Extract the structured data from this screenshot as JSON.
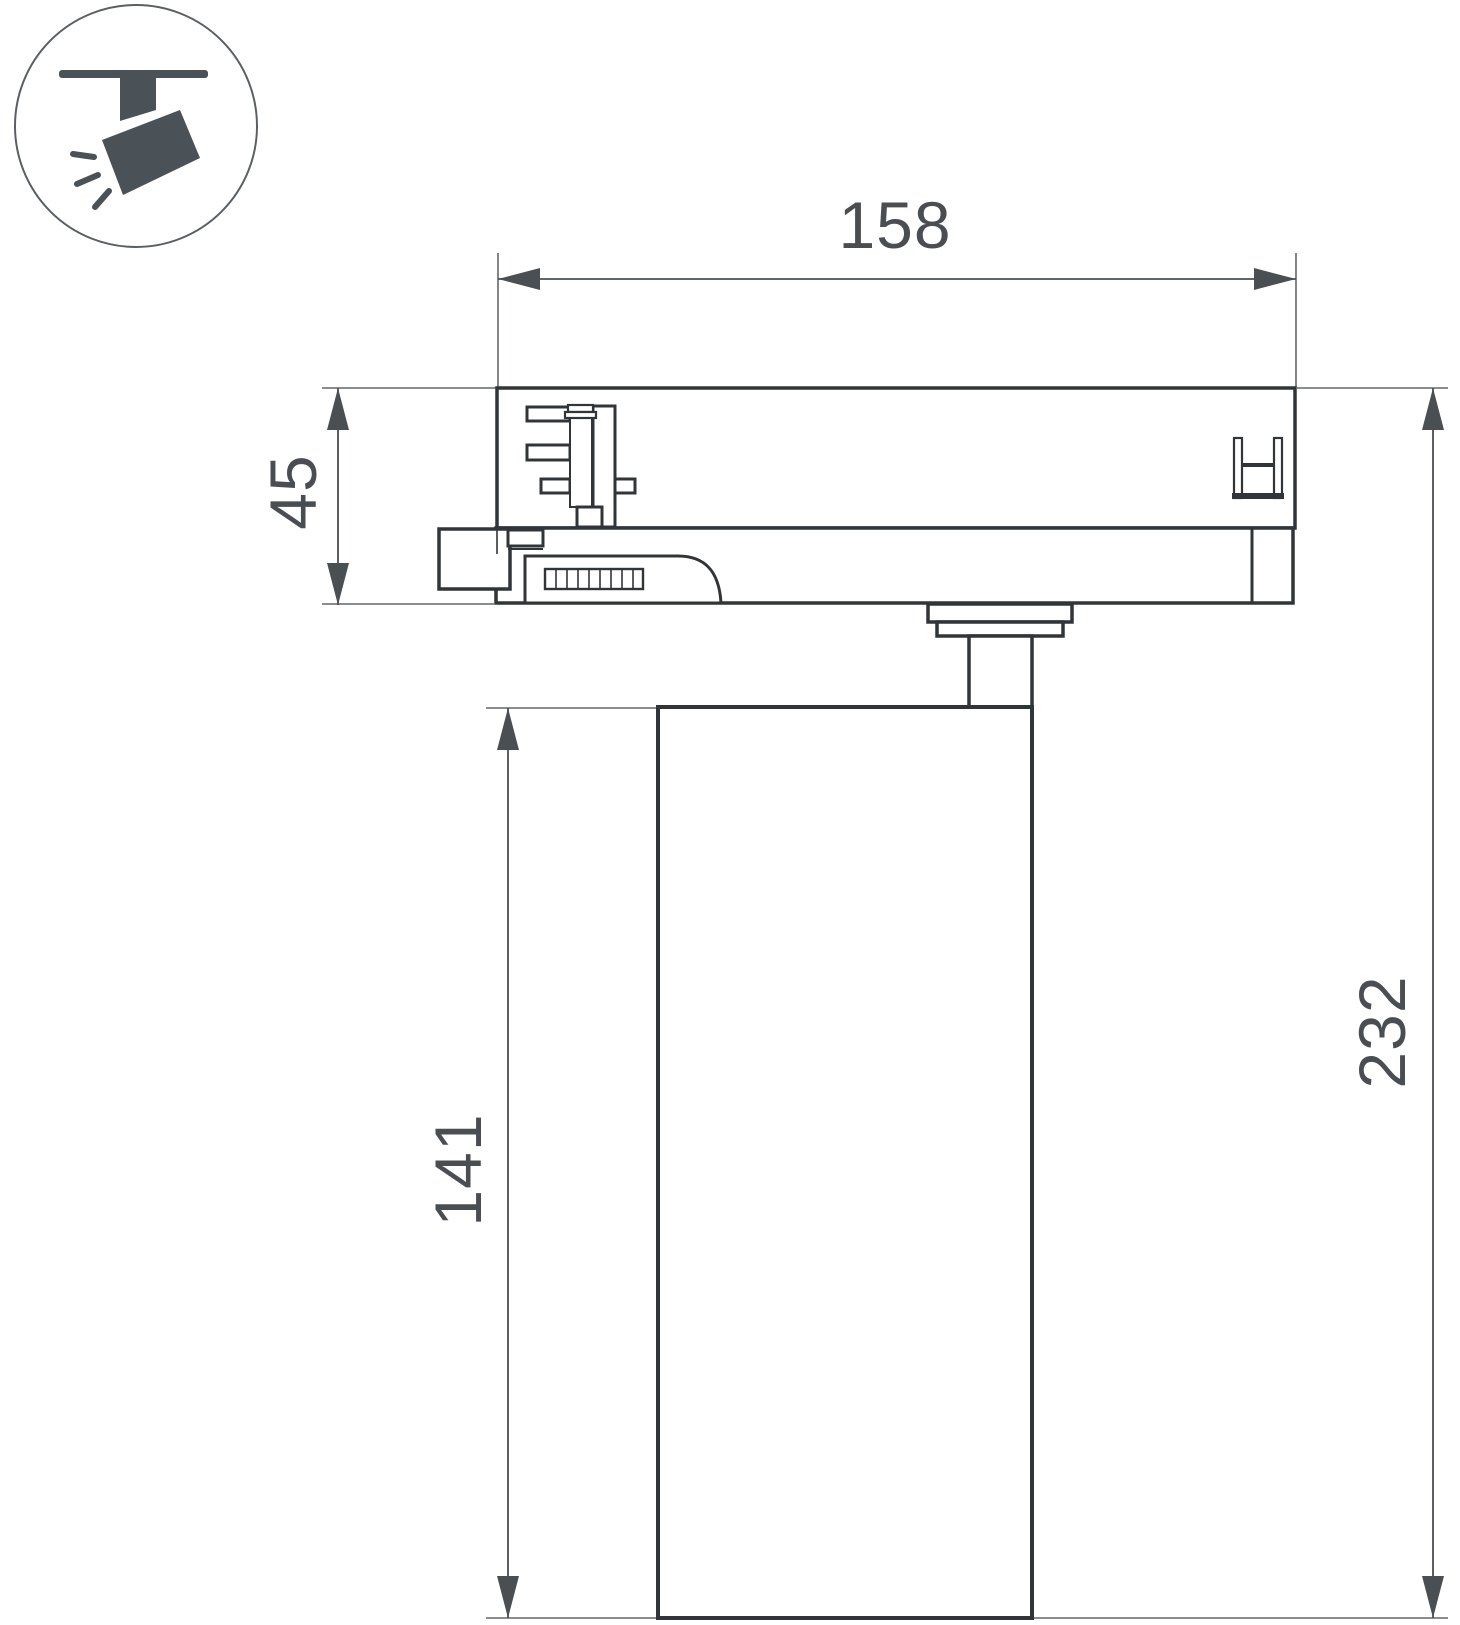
{
  "drawing": {
    "type": "technical-dimension-drawing",
    "subject": "ceiling-track-spotlight",
    "dims": {
      "track_adapter_width": "158",
      "track_adapter_height": "45",
      "lamp_body_height": "141",
      "total_height": "232",
      "lamp_body_diameter": "Ø90"
    },
    "icon": {
      "name": "track-spotlight-icon"
    },
    "colors": {
      "outline": "#303539",
      "dimension_line": "#4a4f54",
      "extension_line": "#62676c",
      "text": "#4a4e53",
      "icon_fill": "#4a5157",
      "background": "#ffffff"
    }
  }
}
